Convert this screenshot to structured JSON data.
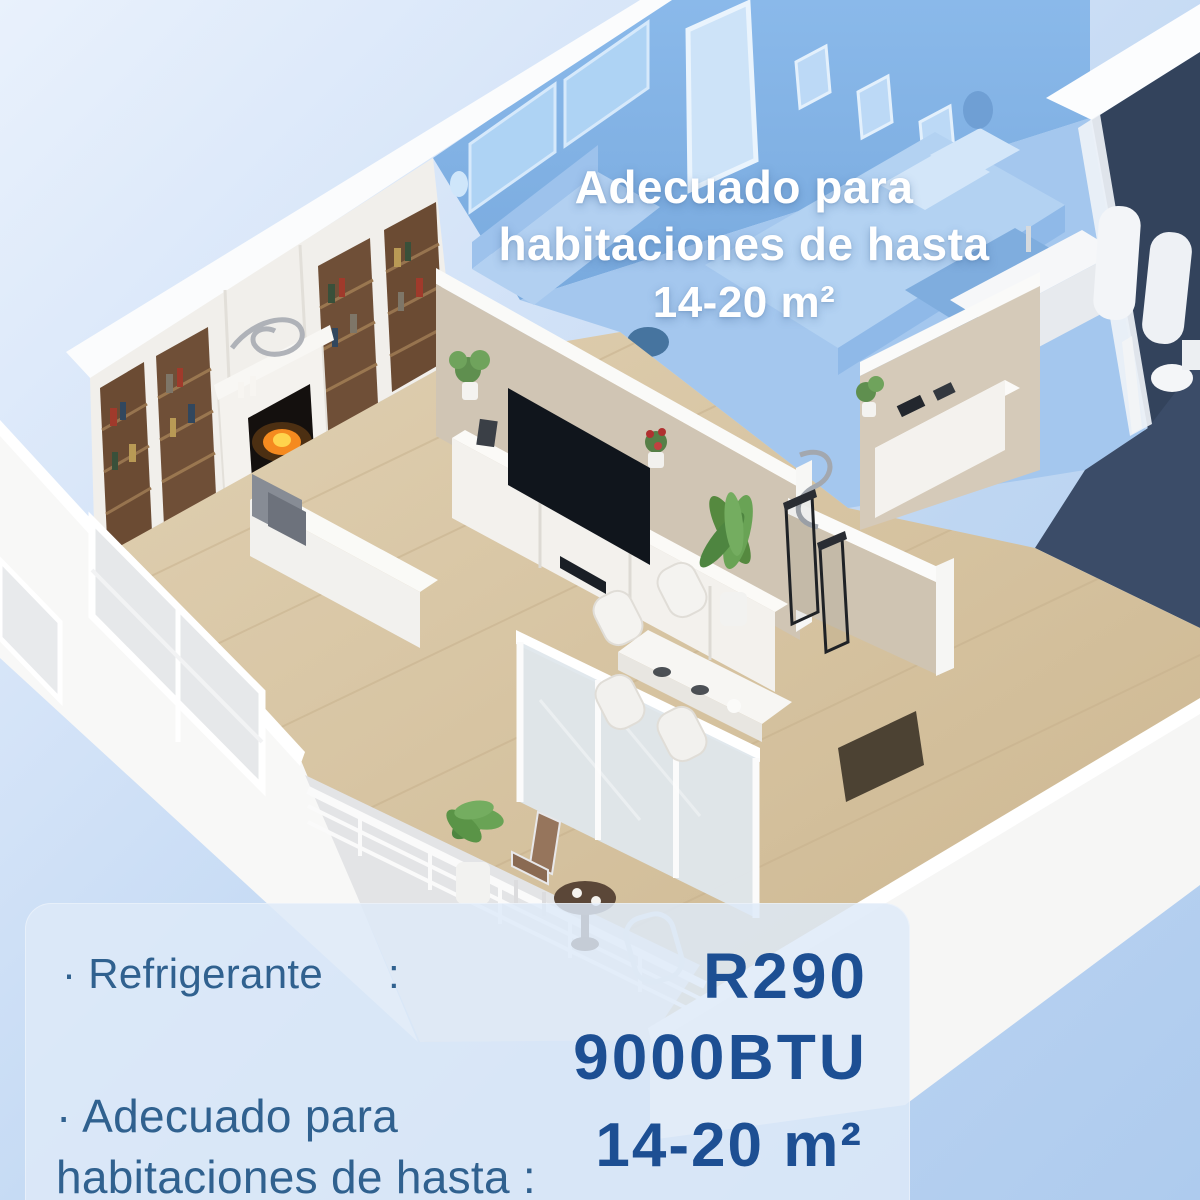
{
  "overlay": {
    "line1": "Adecuado para",
    "line2": "habitaciones de hasta",
    "line3": "14-20 m²"
  },
  "panel": {
    "row1": {
      "label": "· Refrigerante",
      "colon": ":",
      "value_line1": "R290",
      "value_line2": "9000BTU"
    },
    "row2": {
      "label_line1": "· Adecuado para",
      "label_line2": "habitaciones de hasta :",
      "value": "14-20 m²"
    }
  },
  "colors": {
    "background_top": "#e9f1fc",
    "background_bottom": "#aecbee",
    "panel_bg": "#dee9f8",
    "label_blue": "#30618f",
    "value_navy": "#1d4f93",
    "overlay_text": "#ffffff",
    "highlighted_room_blue": "#82b2e4",
    "bathroom_tile_navy": "#33435c",
    "wood_floor": "#d8c5a4",
    "beige_wall": "#d0c5b4",
    "white_wall": "#f1efeb"
  }
}
